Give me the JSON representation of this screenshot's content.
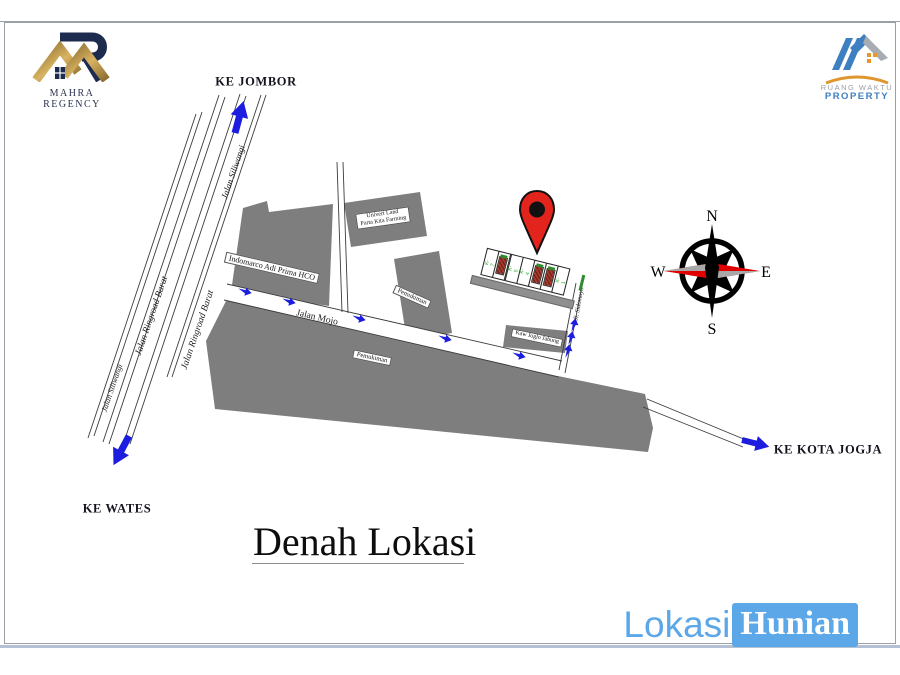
{
  "header": {
    "mahra_logo": {
      "caption": "MAHRA REGENCY"
    },
    "ruangwaktu_logo": {
      "line1": "RUANG WAKTU",
      "line2": "PROPERTY"
    }
  },
  "title": {
    "text": "Denah Lokasi"
  },
  "watermark": {
    "lokasi": "Lokasi",
    "hunian": "Hunian"
  },
  "directions": {
    "jombor": "KE JOMBOR",
    "wates": "KE WATES",
    "jogja": "KE KOTA JOGJA"
  },
  "roads": {
    "siliwangi_upper": "Jalan Siliwangi",
    "ringroad_left": "Jalan Ringroad Barat",
    "ringroad_right": "Jalan Ringroad Barat",
    "siliwangi_lower": "Jalan Siliwangi",
    "mojo": "Jalan Mojo",
    "sidomoyo": "Jl. Sidomoyo"
  },
  "buildings": {
    "indomarco": "Indomarco Adi Prima HCO",
    "univert_line1": "Univert Land",
    "univert_line2": "Parta Kita Farming",
    "pemukiman_mid": "Pemukiman",
    "pemukiman_big": "Pemukiman",
    "joglo": "Kaw Joglo Jabung"
  },
  "site_plan": {
    "plots": [
      "K-7",
      "K-6",
      "K-5",
      "K-4",
      "K-3",
      "K-2",
      "K-1"
    ]
  },
  "compass": {
    "n": "N",
    "e": "E",
    "s": "S",
    "w": "W"
  },
  "colors": {
    "arrow_blue": "#1d1de0",
    "building_gray": "#7e7e7e",
    "pin_red": "#e3241d",
    "plot_green": "#1fa51f",
    "watermark_blue": "#5ba7e8",
    "logo_gold": "#c9a24b",
    "logo_navy": "#1d2b4f",
    "compass_red": "#e00000"
  }
}
